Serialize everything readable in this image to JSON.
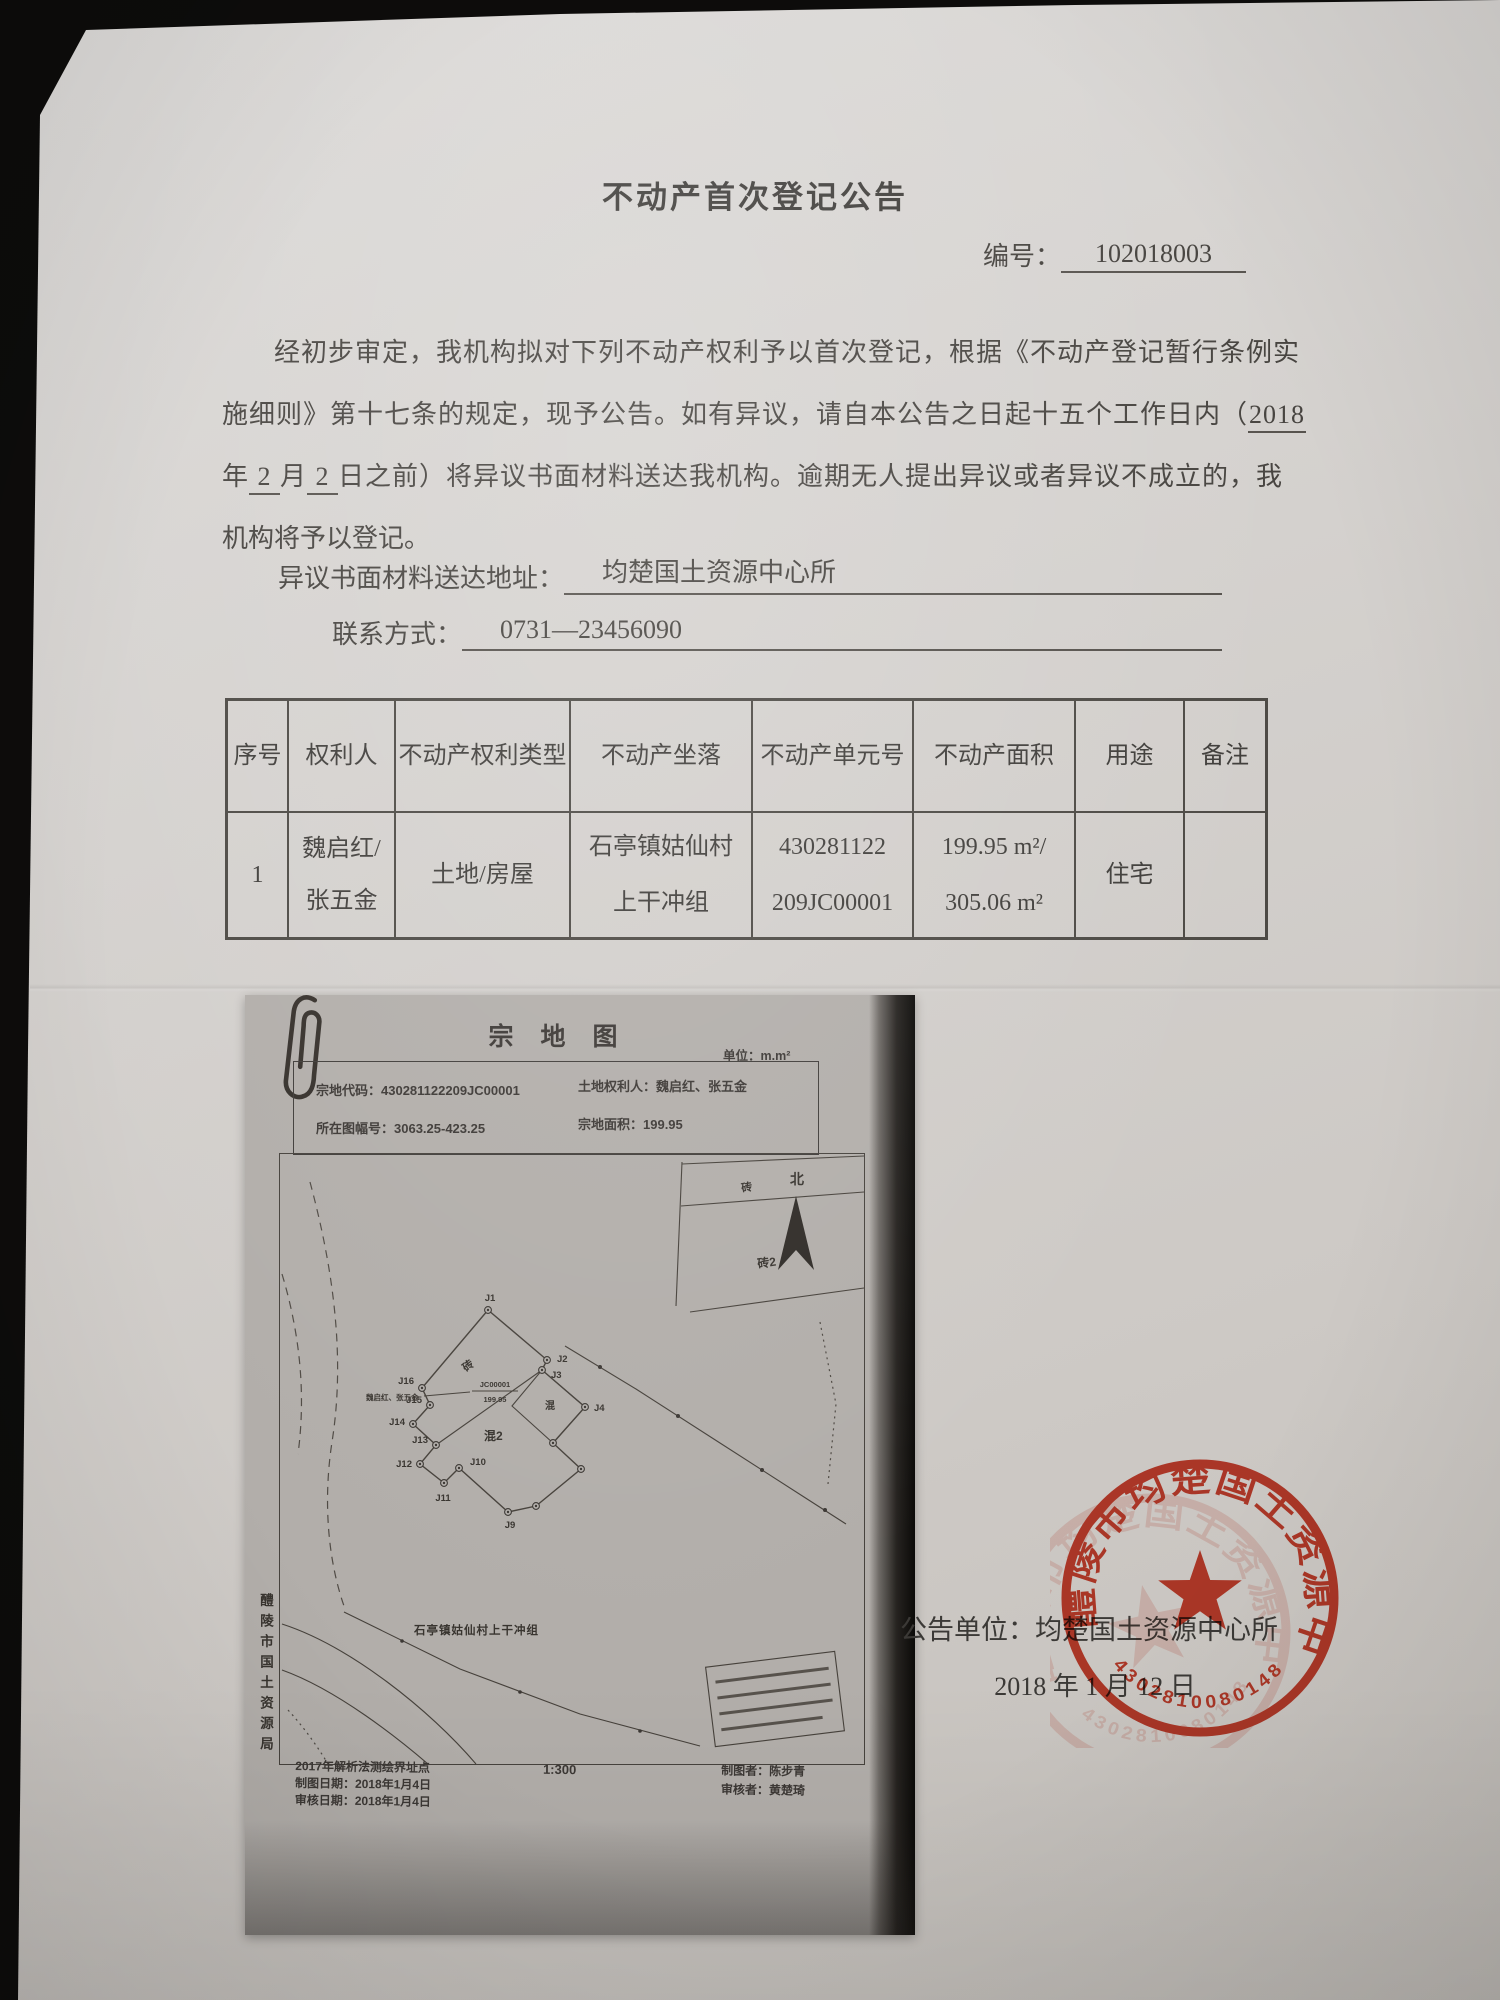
{
  "doc": {
    "title": "不动产首次登记公告",
    "no_label": "编号：",
    "no_value": "102018003",
    "p_line1": "经初步审定，我机构拟对下列不动产权利予以首次登记，根据《不动产登记暂行条例实",
    "p_line2": "施细则》第十七条的规定，现予公告。如有异议，请自本公告之日起十五个工作日内（",
    "p_line2_u": "2018",
    "p_line3_a": "年",
    "p_line3_u1": " 2 ",
    "p_line3_b": "月",
    "p_line3_u2": " 2 ",
    "p_line3_c": "日之前）将异议书面材料送达我机构。逾期无人提出异议或者异议不成立的，我",
    "p_line4": "机构将予以登记。",
    "address_label": "异议书面材料送达地址：",
    "address_value": "均楚国土资源中心所",
    "contact_label": "联系方式：",
    "contact_value": "0731—23456090"
  },
  "table": {
    "headers": [
      "序号",
      "权利人",
      "不动产权利类型",
      "不动产坐落",
      "不动产单元号",
      "不动产面积",
      "用途",
      "备注"
    ],
    "rows": [
      {
        "no": "1",
        "holder1": "魏启红/",
        "holder2": "张五金",
        "right_type": "土地/房屋",
        "loc1": "石亭镇姑仙村",
        "loc2": "上干冲组",
        "unit1": "430281122",
        "unit2": "209JC00001",
        "area1": "199.95 m²/",
        "area2": "305.06 m²",
        "usage": "住宅",
        "remark": ""
      }
    ]
  },
  "map": {
    "title": "宗 地 图",
    "unit": "单位：m.m²",
    "parcel_code": "宗地代码：430281122209JC00001",
    "land_holder": "土地权利人：魏启红、张五金",
    "sheet_no": "所在图幅号：3063.25-423.25",
    "parcel_area": "宗地面积：199.95",
    "north": "北",
    "neighbor_brick": "砖",
    "neighbor_brick2": "砖2",
    "label_brick": "砖",
    "label_concrete2": "混2",
    "label_concrete": "混",
    "inner_owner": "魏启红、张五金",
    "inner_code": "JC00001",
    "inner_area": "199.95",
    "village": "石亭镇姑仙村上干冲组",
    "points": {
      "j1": "J1",
      "j2": "J2",
      "j3": "J3",
      "j4": "J4",
      "j9": "J9",
      "j10": "J10",
      "j11": "J11",
      "j12": "J12",
      "j13": "J13",
      "j14": "J14",
      "j15": "J15",
      "j16": "J16"
    },
    "footnote1": "2017年解析法测绘界址点",
    "footnote2": "制图日期：2018年1月4日",
    "footnote3": "审核日期：2018年1月4日",
    "scale": "1:300",
    "drafter": "制图者：陈步青",
    "reviewer": "审核者：黄楚琦",
    "agency": "醴陵市国土资源局"
  },
  "footer": {
    "issuer_label": "公告单位：",
    "issuer": "均楚国土资源中心所",
    "date": "2018 年 1 月 12 日"
  },
  "stamp": {
    "ring_text": "醴陵市均楚国土资源中心所",
    "serial": "4302810080148",
    "color": "#d23722"
  }
}
